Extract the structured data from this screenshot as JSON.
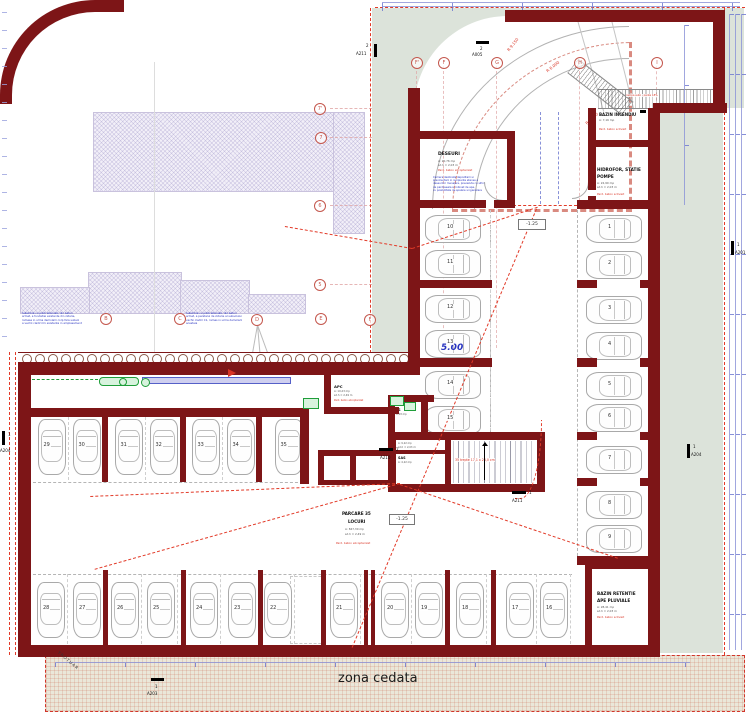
{
  "colors": {
    "wall": "#7d1517",
    "accent_red": "#d93425",
    "accent_blue": "#2a35c0",
    "sage": "#dce3da",
    "green": "#1f9e3a",
    "lavender": "#f2eff8"
  },
  "rooms": {
    "deseuri": {
      "name": "DESEURI",
      "area": "A: 20,76 mp",
      "height": "sd.h = 2,03 m",
      "finish": "Pard. beton elicopterizat",
      "note": "Camera destinata depozitarii si\nprecolectarii in recipiente etanse a\ndeseurilor menajere, prevazuta cu sifon\nde pardoseala si robinet de apa,\ncu posibilitate de spalare si igienizare"
    },
    "bazin_incendiu": {
      "name": "BAZIN INCENDIU",
      "area": "A: 7,16 mp",
      "finish": "Pard. beton sclivisit"
    },
    "hidrofor": {
      "name": "HIDROFOR, STATIE",
      "name2": "POMPE",
      "area": "A: 22,90 mp",
      "height": "sd.h = 2,03 m",
      "finish": "Pard. beton sclivisit"
    },
    "bazin_retentie": {
      "name": "BAZIN RETENTIE",
      "name2": "APE PLUVIALE",
      "area": "A: 28,41 mp",
      "height": "sd.h = 2,03 m",
      "finish": "Pard. beton sclivisit"
    },
    "apc": {
      "name": "APC",
      "area": "A: 10,23 mp",
      "height": "sd.h = 2,49 m",
      "finish": "Pard. beton elicopterizat"
    },
    "sas1": {
      "name": "SAS",
      "area": "A: 2,03 mp"
    },
    "sas2": {
      "name": "SAS",
      "area": "A: 4,22 mp"
    },
    "spatiu_comun": {
      "name": "SPATIU COMUN",
      "area": "A: 9,22 mp",
      "height": "sd.h = 2,03 m"
    },
    "scara": {
      "name": "SCARA",
      "stairs": "35 trepte 17,1 x 28,0 cm"
    },
    "parcare": {
      "name": "PARCARE 35",
      "name2": "LOCURI",
      "area": "A: 847,30 mp",
      "height": "sd.h = 2,49 m",
      "finish": "Pard. beton elicopterizat"
    }
  },
  "stalls": {
    "right": [
      "1",
      "2",
      "3",
      "4",
      "5",
      "6",
      "7",
      "8",
      "9"
    ],
    "mid": [
      "10",
      "11",
      "12",
      "13",
      "14",
      "15"
    ],
    "left": [
      "29",
      "30",
      "31",
      "32",
      "33",
      "34",
      "35"
    ],
    "bottom": [
      "28",
      "27",
      "26",
      "25",
      "24",
      "23",
      "22",
      "21",
      "20",
      "19",
      "18",
      "17",
      "16"
    ]
  },
  "elevations": {
    "entry": "-1.25",
    "hall": "-1.25",
    "dim": "5.00"
  },
  "ramp": {
    "r1": "R 9.150",
    "r2": "R 6.000",
    "r3": "R 5.100",
    "label": "rampa auto - panta 18%"
  },
  "zona_cedata": {
    "label": "zona cedata"
  },
  "trotuar": "TROTUAR",
  "annotations": {
    "left": "Subzidire cu piloti alternati, din beton\narmat, a fundatiei existente din zidarie,\nramasa in urma demolarii corp fara subsol\na vechii cladiri C1 existenta in amplasament",
    "mid": "Subzidire cu piloti alternati, din beton\narmat, a peretelui de zidarie al subsolului\nvechii cladiri C1, ramas in urma demolarii\nacesteia"
  },
  "bubbles": {
    "top": [
      "F'",
      "F",
      "G",
      "H",
      "I"
    ],
    "left": [
      "7'",
      "7",
      "6",
      "5"
    ],
    "mid": [
      "B",
      "C",
      "D",
      "E",
      "F"
    ]
  },
  "markers": [
    {
      "num": "2",
      "sheet": "A211"
    },
    {
      "num": "2",
      "sheet": "A005"
    },
    {
      "num": "1",
      "sheet": "A201"
    },
    {
      "num": "1",
      "sheet": "A204"
    },
    {
      "num": "1",
      "sheet": "A204"
    },
    {
      "num": "2",
      "sheet": "A210"
    },
    {
      "num": "1",
      "sheet": "A211"
    },
    {
      "num": "1",
      "sheet": "A203"
    }
  ]
}
